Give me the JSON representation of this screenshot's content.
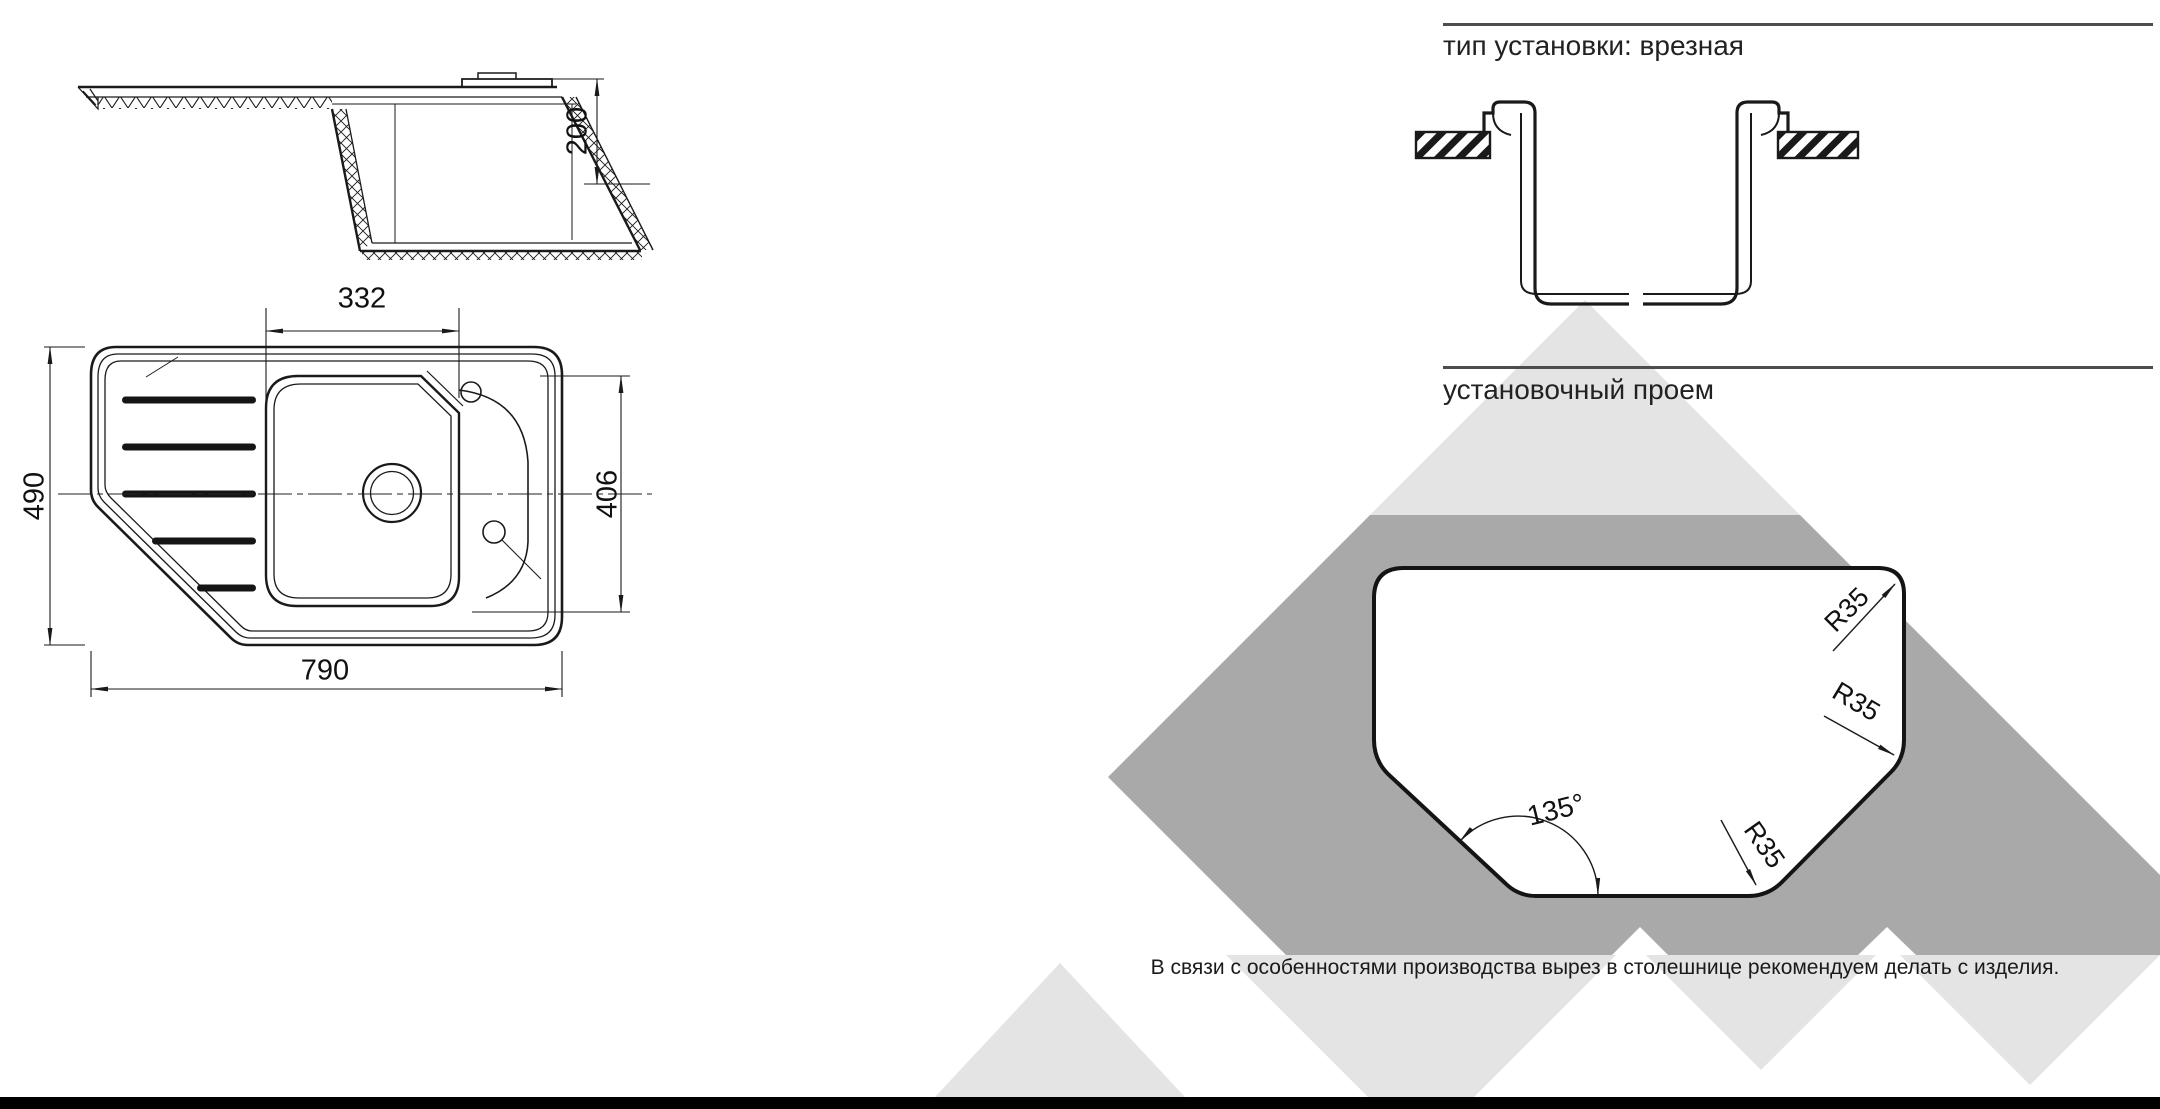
{
  "dims": {
    "side_depth": "200",
    "bowl_width": "332",
    "overall_width": "490",
    "bowl_length": "406",
    "overall_length": "790"
  },
  "sections": {
    "install_title": "тип установки: врезная",
    "opening_title": "установочный проем"
  },
  "annotations": {
    "r35_top": "R35",
    "r35_mid": "R35",
    "r35_bottom": "R35",
    "angle": "135°"
  },
  "note_text": "В связи с особенностями производства вырез в столешнице рекомендуем делать с изделия.",
  "colors": {
    "line": "#1a1a1a",
    "rule_gray": "#4d4d4d",
    "light_gray": "#e4e4e4",
    "dark_gray": "#a9a9a9",
    "footer_black": "#000000"
  }
}
